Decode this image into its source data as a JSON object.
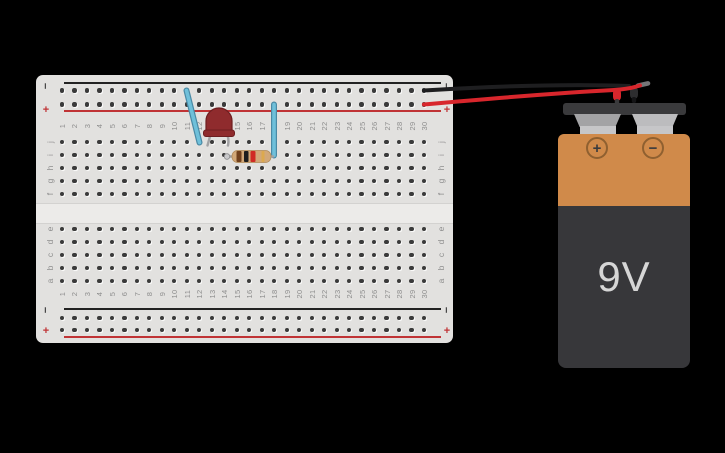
{
  "canvas": {
    "background": "#000000"
  },
  "breadboard": {
    "column_numbers": [
      "1",
      "2",
      "3",
      "4",
      "5",
      "6",
      "7",
      "8",
      "9",
      "10",
      "11",
      "12",
      "13",
      "14",
      "15",
      "16",
      "17",
      "18",
      "19",
      "20",
      "21",
      "22",
      "23",
      "24",
      "25",
      "26",
      "27",
      "28",
      "29",
      "30"
    ],
    "row_letters_top": [
      "j",
      "i",
      "h",
      "g",
      "f"
    ],
    "row_letters_bottom": [
      "e",
      "d",
      "c",
      "b",
      "a"
    ],
    "rail_negative_symbol": "−",
    "rail_positive_symbol": "+",
    "colors": {
      "board": "#e2e1df",
      "channel": "#ecebe9",
      "hole": "#3a3a3a",
      "negative_line": "#222222",
      "positive_line": "#c03335",
      "label": "#8e8e8e"
    }
  },
  "components": {
    "led": {
      "body": "#8f2b2d",
      "edge": "#6d1e20"
    },
    "resistor": {
      "body": "#d2a878",
      "edge": "#b08a58",
      "lead": "#a2a2a4",
      "bands": {
        "band1": "#70401d",
        "band2": "#1e1e1e",
        "band3": "#d02b24",
        "band4": "#dca94e"
      }
    },
    "wires": {
      "blue": "#6fc0da",
      "blue_edge": "#4a8aa5",
      "red": "#d8262c",
      "black": "#1e1e20"
    }
  },
  "battery": {
    "label": "9V",
    "positive_symbol": "+",
    "negative_symbol": "−",
    "colors": {
      "cap": "#3a3a3c",
      "terminal": "#a3a3a5",
      "terminal_light": "#bcbcbe",
      "terminal_base": "#c6c6c8",
      "body": "#d08a4a",
      "sleeve": "#37373a",
      "symbol_ring": "#8f6030",
      "symbol": "#3b3b3d",
      "label": "#d6d6d6"
    }
  }
}
